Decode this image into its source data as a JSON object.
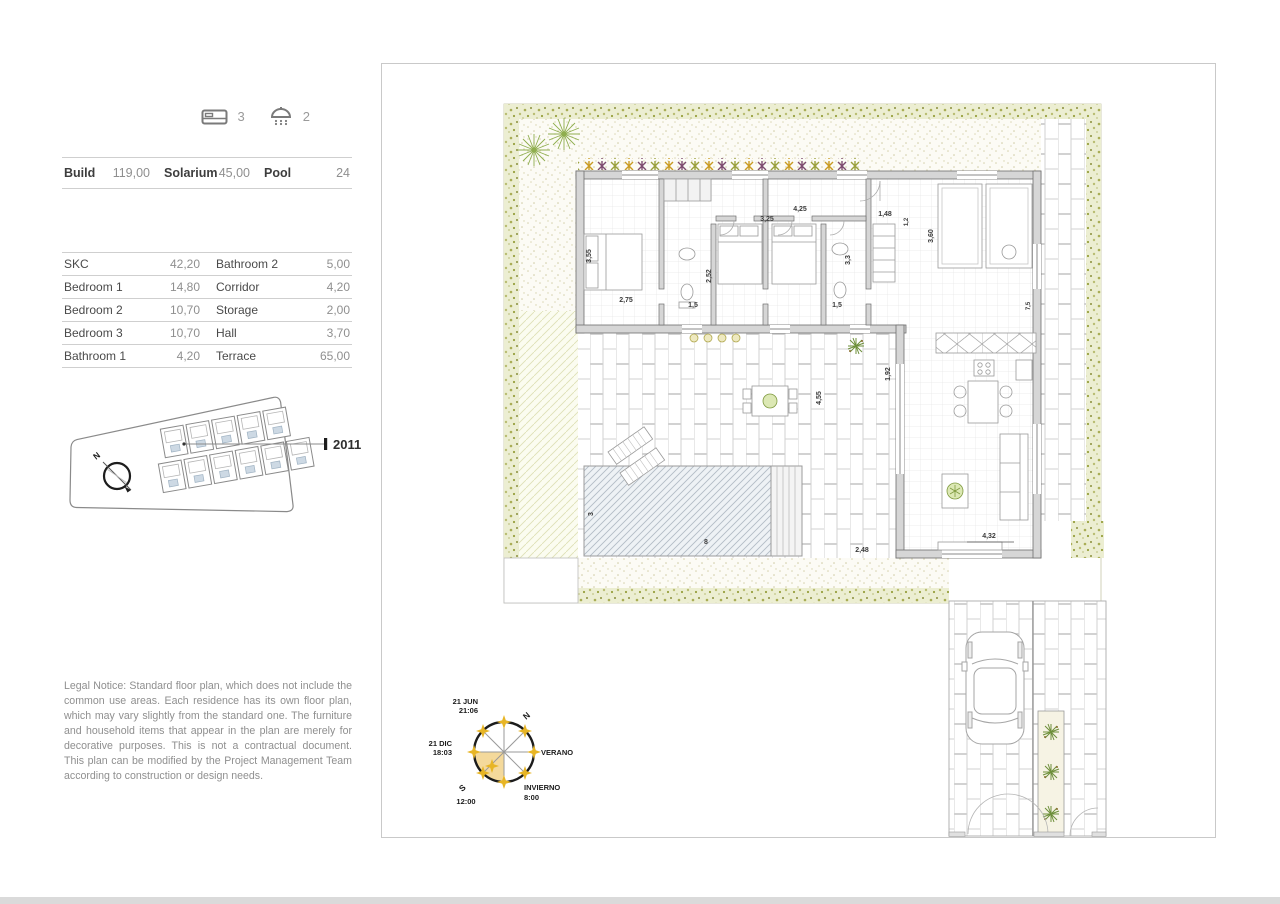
{
  "palette": {
    "hedge_green": "#b7bb6a",
    "sun_yellow": "#e7b525",
    "wall_gray": "#d6d6d6",
    "line_gray": "#cfcfcf",
    "text_dark": "#3d3d3d",
    "text_muted": "#8f8f8f"
  },
  "header": {
    "bedrooms": "3",
    "bathrooms": "2",
    "bed_icon": "bed-icon",
    "shower_icon": "shower-icon"
  },
  "summary": {
    "items": [
      {
        "label": "Build",
        "value": "119,00"
      },
      {
        "label": "Solarium",
        "value": "45,00"
      },
      {
        "label": "Pool",
        "value": "24"
      }
    ]
  },
  "rooms": {
    "rows": [
      {
        "l1": "SKC",
        "v1": "42,20",
        "l2": "Bathroom 2",
        "v2": "5,00"
      },
      {
        "l1": "Bedroom 1",
        "v1": "14,80",
        "l2": "Corridor",
        "v2": "4,20"
      },
      {
        "l1": "Bedroom 2",
        "v1": "10,70",
        "l2": "Storage",
        "v2": "2,00"
      },
      {
        "l1": "Bedroom 3",
        "v1": "10,70",
        "l2": "Hall",
        "v2": "3,70"
      },
      {
        "l1": "Bathroom 1",
        "v1": "4,20",
        "l2": "Terrace",
        "v2": "65,00"
      }
    ]
  },
  "site_plan": {
    "unit_label": "2011",
    "compass_n": "N"
  },
  "legal": {
    "text": "Legal Notice: Standard floor plan, which does not include the common use areas. Each residence has its own floor plan, which may vary slightly from the standard one. The furniture and household items that appear in the plan are merely for decorative purposes. This is not a contractual document. This plan can be modified by the Project Management Team according to construction or design needs."
  },
  "sun": {
    "n": "N",
    "s": "S",
    "summer": "VERANO",
    "winter": "INVIERNO",
    "jun_date": "21 JUN",
    "jun_time": "21:06",
    "dec_date": "21 DIC",
    "dec_time": "18:03",
    "noon": "12:00",
    "winter_sunrise": "8:00"
  },
  "plan": {
    "dims": [
      "3,55",
      "2,75",
      "2,52",
      "1,5",
      "3,25",
      "4,25",
      "3,3",
      "1,5",
      "1,48",
      "1,2",
      "3,60",
      "7,5",
      "4,55",
      "1,92",
      "4,32",
      "2,48",
      "3",
      "8"
    ]
  }
}
